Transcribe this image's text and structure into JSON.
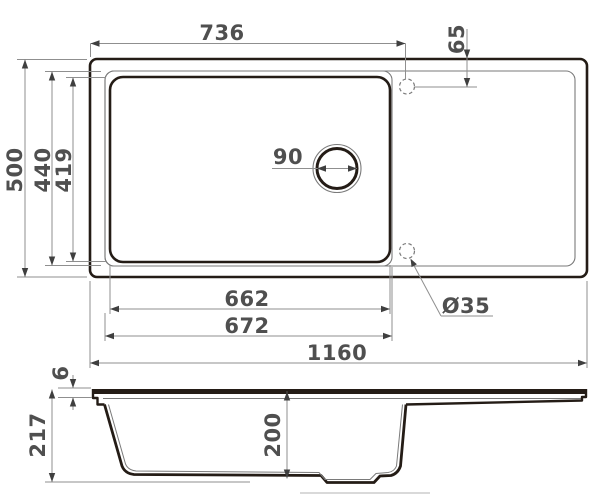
{
  "drawing": {
    "type": "technical-dimension-drawing",
    "subject": "kitchen sink with bowl, drain and drainboard — top view and side section view",
    "units": "mm",
    "views": [
      "top-view",
      "side-section-view"
    ]
  },
  "dimensions": {
    "bowl_to_tap_width": "736",
    "tap_hole_edge_offset": "65",
    "overall_depth": "500",
    "rim_inner_depth": "440",
    "bowl_depth_top": "419",
    "drain_diameter": "90",
    "bowl_inner_width": "662",
    "bowl_outer_width": "672",
    "overall_width": "1160",
    "tap_hole_diameter": "Ø35",
    "rim_thickness": "6",
    "total_height": "217",
    "bowl_height": "200"
  },
  "colors": {
    "outline_ink": "#241c16",
    "thin_line": "#7a7a7a",
    "dimension_line": "#8f8f8f",
    "dimension_text": "#4f4f4f",
    "background": "#ffffff"
  }
}
